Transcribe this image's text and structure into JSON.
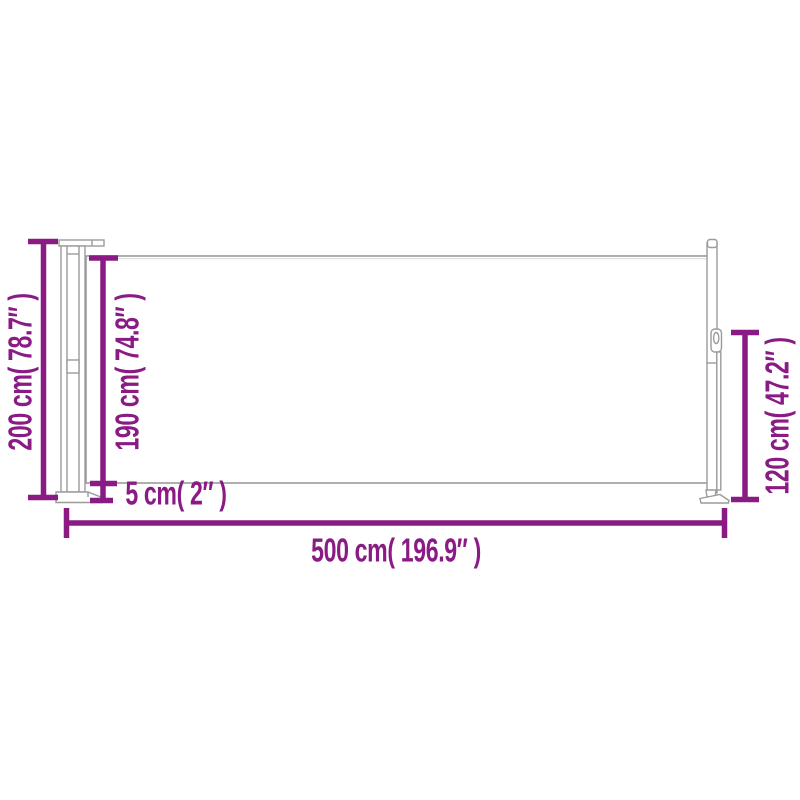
{
  "colors": {
    "dimension": "#8A1B84",
    "outline": "#9B9B9B",
    "outline_light": "#D9D9D9",
    "background": "#FFFFFF"
  },
  "diagram": {
    "name": "retractable-side-awning-dimension-diagram",
    "measurements": [
      {
        "id": "total_height",
        "label": "200 cm( 78.7″ )",
        "cm": 200,
        "inches": 78.7,
        "orientation": "vertical",
        "position": "left"
      },
      {
        "id": "fabric_height",
        "label": "190 cm( 74.8″ )",
        "cm": 190,
        "inches": 74.8,
        "orientation": "vertical",
        "position": "inner-left"
      },
      {
        "id": "bottom_gap",
        "label": "5 cm( 2″ )",
        "cm": 5,
        "inches": 2,
        "orientation": "vertical",
        "position": "bottom-left"
      },
      {
        "id": "total_length",
        "label": "500 cm( 196.9″ )",
        "cm": 500,
        "inches": 196.9,
        "orientation": "horizontal",
        "position": "bottom"
      },
      {
        "id": "end_height",
        "label": "120 cm( 47.2″ )",
        "cm": 120,
        "inches": 47.2,
        "orientation": "vertical",
        "position": "right"
      }
    ]
  }
}
